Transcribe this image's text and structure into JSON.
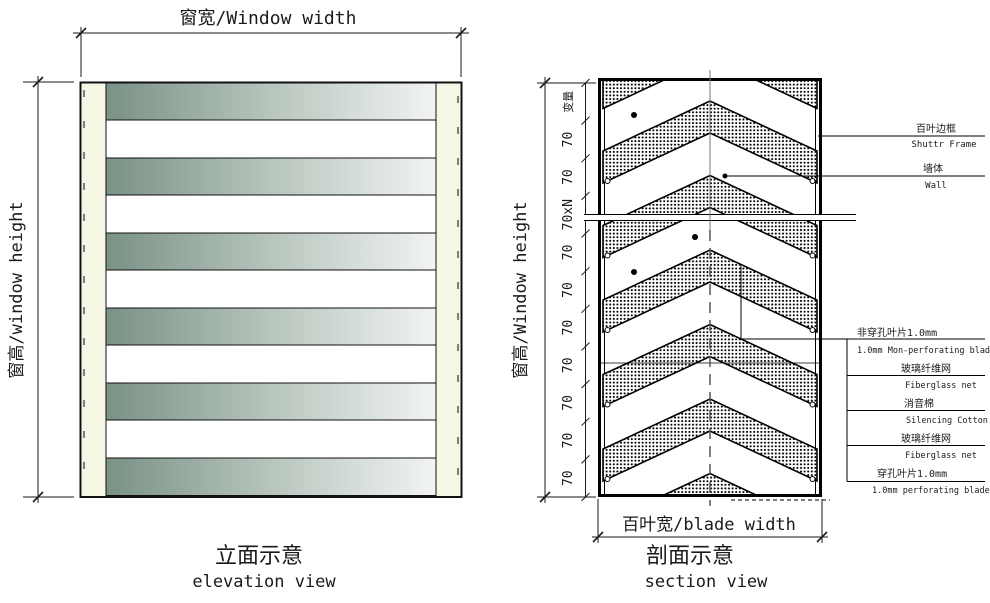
{
  "elevation": {
    "window_width_label": "窗宽/Window width",
    "window_height_label": "窗高/window height",
    "caption_cn": "立面示意",
    "caption_en": "elevation view",
    "slat_count": 6
  },
  "section": {
    "window_height_label": "窗高/Window height",
    "blade_width_label": "百叶宽/blade width",
    "caption_cn": "剖面示意",
    "caption_en": "section view",
    "dim_labels": [
      "变量",
      "70",
      "70",
      "70xN",
      "70",
      "70",
      "70",
      "70",
      "70",
      "70",
      "70"
    ],
    "callouts": {
      "frame": {
        "cn": "百叶边框",
        "en": "Shuttr Frame"
      },
      "wall": {
        "cn": "墙体",
        "en": "Wall"
      },
      "layers": [
        {
          "cn": "非穿孔叶片1.0mm",
          "en": "1.0mm Mon-perforating blade"
        },
        {
          "cn": "玻璃纤维网",
          "en": "Fiberglass net"
        },
        {
          "cn": "消音棉",
          "en": "Silencing Cotton"
        },
        {
          "cn": "玻璃纤维网",
          "en": "Fiberglass net"
        },
        {
          "cn": "穿孔叶片1.0mm",
          "en": "1.0mm perforating blade"
        }
      ]
    }
  },
  "colors": {
    "slat_dark": "#7a9186",
    "slat_mid": "#b7c5bd",
    "slat_light": "#f2f4f2",
    "frame_cream": "#f5f6e4",
    "line": "#1a1a1a"
  }
}
